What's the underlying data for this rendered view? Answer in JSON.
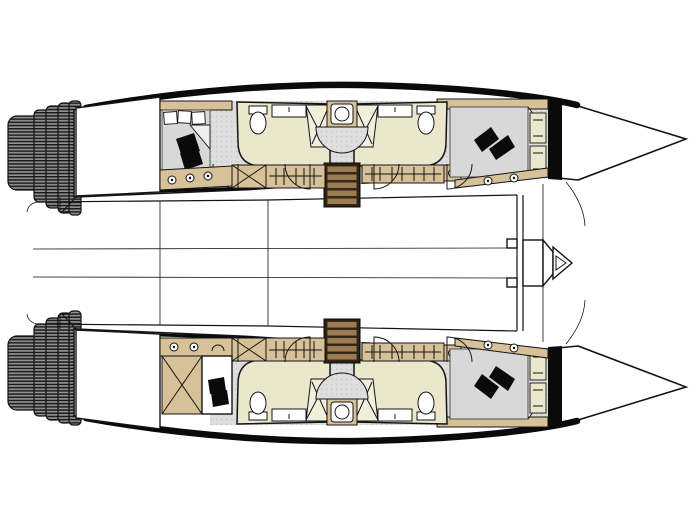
{
  "meta": {
    "label": "Catamaran sailing yacht deck plan, top-down interior layout, bows to the right",
    "diagram_type": "boat-floor-plan"
  },
  "colors": {
    "hullOutline": "#141414",
    "accentBlack": "#0a0a0a",
    "white": "#ffffff",
    "furnitureTan": "#d7c198",
    "bathroomCream": "#eae7cd",
    "showerTray": "#f1eedb",
    "floorGray": "#dedede",
    "floorDot": "#c6c6c6",
    "bedGray": "#d8d8d8",
    "stairTread": "#9c7a52",
    "stairFrame": "#2c2014",
    "stepBase": "#909090",
    "stepLine": "#1c1c1c"
  },
  "vessel": {
    "type": "catamaran",
    "orientation": "bows pointing right, transom steps on the left",
    "hulls": [
      {
        "id": "port-hull-top",
        "features": [
          "transom-steps",
          "aft-deck",
          "aft-double-berth-with-pillows",
          "hanging-lockers",
          "bathroom-with-toilet-basin-shower",
          "companionway-stairs",
          "second-bathroom",
          "central-washbasin",
          "forward-berth-with-black-cushions",
          "bow-shelves",
          "portholes",
          "collision-bulkhead",
          "bow-peak"
        ]
      },
      {
        "id": "starboard-hull-bottom",
        "features": [
          "transom-steps",
          "aft-deck",
          "aft-storage-with-x-brace",
          "desk-with-chair",
          "hanging-lockers",
          "bathroom-with-toilet-basin-shower",
          "companionway-stairs",
          "second-bathroom",
          "central-washbasin",
          "forward-berth-with-black-cushions",
          "bow-shelves",
          "portholes",
          "collision-bulkhead",
          "bow-peak"
        ]
      }
    ],
    "bridgedeck": {
      "features": [
        "cockpit-area",
        "saloon-grid-lines",
        "forward-crossbeam",
        "bowsprit-fitting"
      ]
    },
    "counts": {
      "cabins": 4,
      "bathrooms": 4,
      "companionway_stairs": 2,
      "transom_step_flights": 2
    }
  }
}
